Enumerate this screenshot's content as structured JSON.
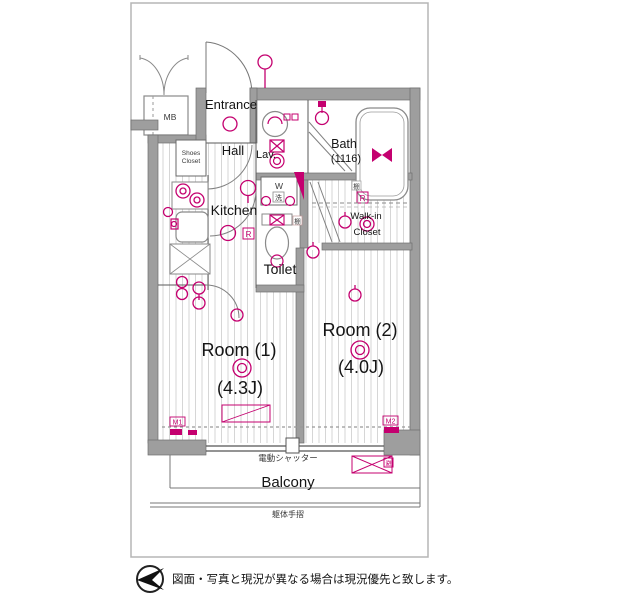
{
  "colors": {
    "accent": "#c4006f",
    "wall": "#9e9e9e",
    "frame": "#b5b5b5",
    "hatch": "#d6d6d6"
  },
  "rooms": {
    "entrance": "Entrance",
    "mb": "MB",
    "shoes_closet_line1": "Shoes",
    "shoes_closet_line2": "Closet",
    "hall": "Hall",
    "lav": "Lav.",
    "bath_line1": "Bath",
    "bath_line2": "(1116)",
    "kitchen": "Kitchen",
    "washer": "W",
    "washer_kanji": "洗",
    "toilet": "Toilet",
    "wic_line1": "Walk-in",
    "wic_line2": "Closet",
    "room1_name": "Room (1)",
    "room1_size": "(4.3J)",
    "room2_name": "Room (2)",
    "room2_size": "(4.0J)",
    "balcony": "Balcony"
  },
  "labels": {
    "shutter": "電動シャッター",
    "handrail": "躯体手摺",
    "shelf": "棚",
    "r_mark": "R",
    "m1": "M1",
    "m2": "M2",
    "evac": "避"
  },
  "footer": {
    "disclaimer": "図面・写真と現況が異なる場合は現況優先と致します。"
  }
}
